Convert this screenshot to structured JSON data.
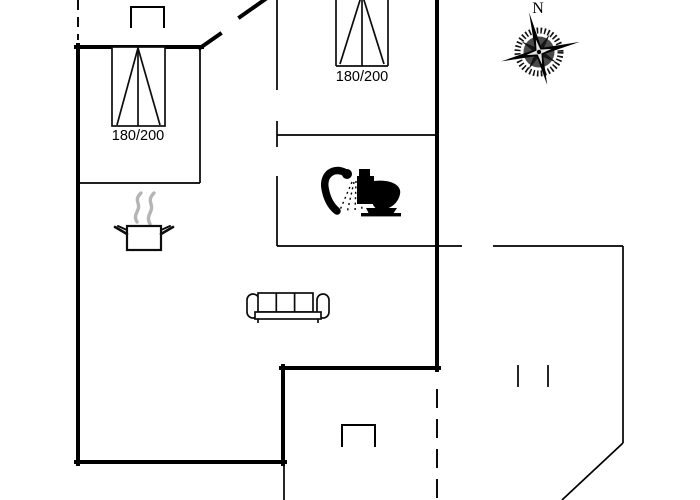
{
  "plan": {
    "beds": [
      {
        "size": "180/200"
      },
      {
        "size": "180/200"
      }
    ],
    "compass": {
      "north_label": "N"
    },
    "icons": {
      "bed": "double-bed-icon",
      "cooking_pot": "cooking-pot-icon",
      "shower": "shower-icon",
      "toilet": "toilet-icon",
      "sofa": "sofa-icon",
      "compass_rose": "compass-rose-icon"
    },
    "colors": {
      "line": "#000000",
      "steam": "#b5b5b5",
      "background": "#ffffff"
    }
  }
}
